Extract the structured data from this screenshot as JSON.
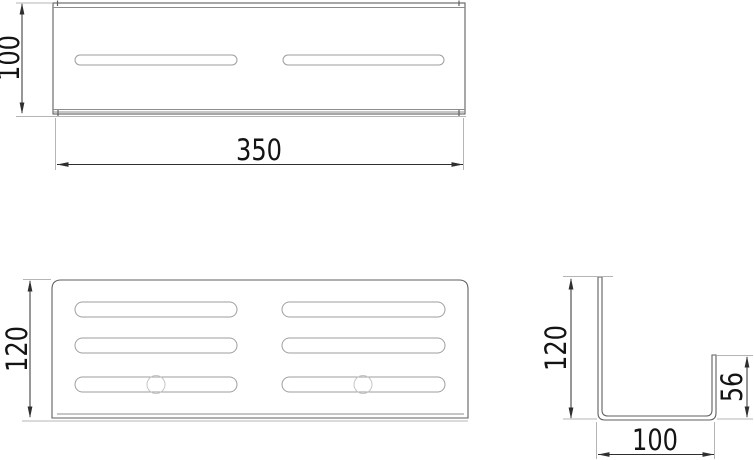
{
  "drawing": {
    "top_view": {
      "height_dim": "100",
      "width_dim": "350"
    },
    "front_view": {
      "height_dim": "120"
    },
    "side_view": {
      "height_dim": "120",
      "lip_dim": "56",
      "width_dim": "100"
    },
    "colors": {
      "background": "#ffffff",
      "outline": "#5f5f5f",
      "inner_line": "#8c8c8c",
      "slot_outline": "#9e9e9e",
      "dimension_line": "#2f2f2f",
      "extension_line": "#b5b5b5",
      "hole_circle": "#c6c6c6",
      "text": "#141414"
    }
  }
}
